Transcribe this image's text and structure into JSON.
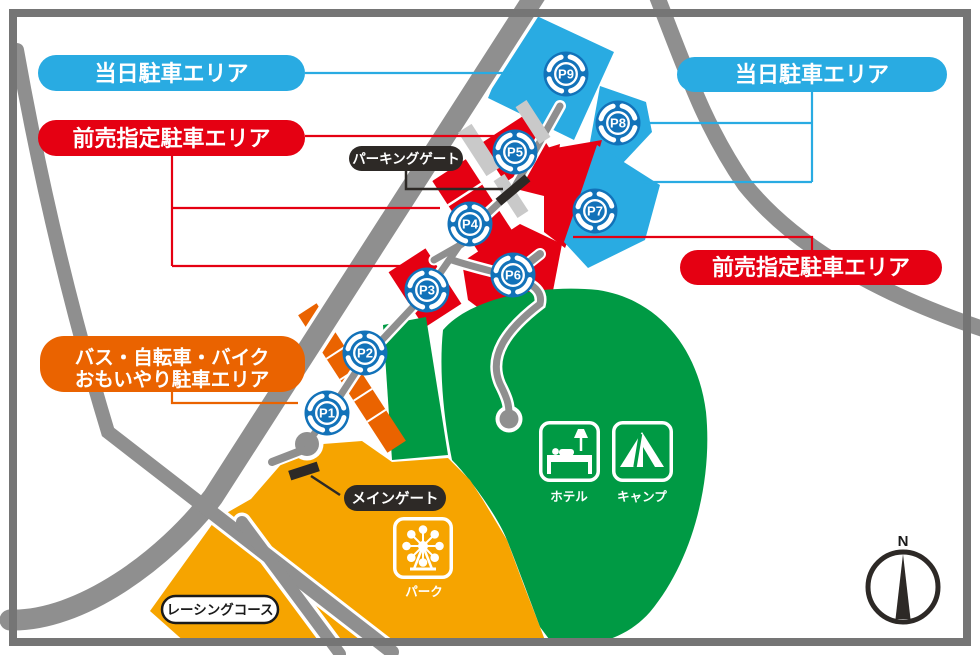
{
  "labels": {
    "same_day_left": "当日駐車エリア",
    "same_day_right": "当日駐車エリア",
    "advance_left": "前売指定駐車エリア",
    "advance_right": "前売指定駐車エリア",
    "special_area_line1": "バス・自転車・バイク",
    "special_area_line2": "おもいやり駐車エリア",
    "parking_gate": "パーキングゲート",
    "main_gate": "メインゲート",
    "racing_course": "レーシングコース",
    "hotel": "ホテル",
    "camp": "キャンプ",
    "park": "パーク",
    "compass_north": "N"
  },
  "markers": [
    {
      "id": "p1",
      "label": "P1"
    },
    {
      "id": "p2",
      "label": "P2"
    },
    {
      "id": "p3",
      "label": "P3"
    },
    {
      "id": "p4",
      "label": "P4"
    },
    {
      "id": "p5",
      "label": "P5"
    },
    {
      "id": "p6",
      "label": "P6"
    },
    {
      "id": "p7",
      "label": "P7"
    },
    {
      "id": "p8",
      "label": "P8"
    },
    {
      "id": "p9",
      "label": "P9"
    }
  ],
  "colors": {
    "same_day_blue": "#29ABE2",
    "advance_red": "#E50012",
    "zone_orange": "#F6A400",
    "accent_orange": "#EA6300",
    "green": "#009A44",
    "marker_blue": "#1272B9",
    "road_gray": "#8F8F8F",
    "light_gray": "#C9C9C9",
    "frame_gray": "#757575",
    "gate_black": "#2D2926"
  }
}
